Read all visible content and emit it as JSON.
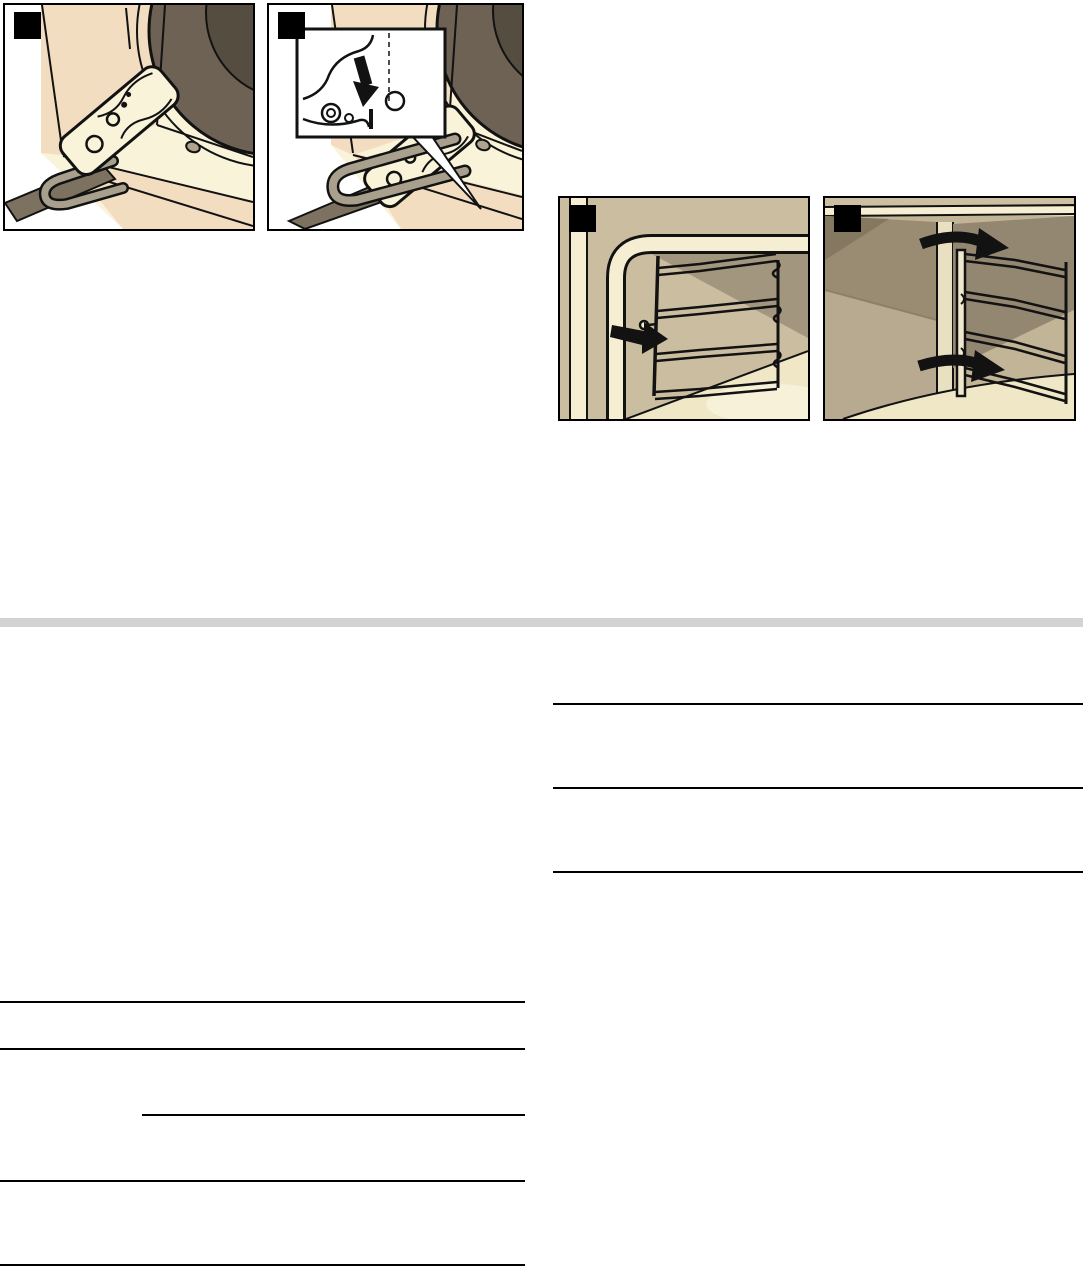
{
  "page": {
    "kind": "appliance manual page",
    "visible_text": ""
  },
  "colors": {
    "page_bg": "#ffffff",
    "panel_bg": "#f8f3d9",
    "panel_border": "#000000",
    "badge_black": "#000000",
    "divider_gray": "#d3d3d3",
    "rule_color": "#000000",
    "outline": "#121212",
    "white": "#ffffff",
    "tan_light": "#f3ddc1",
    "tan_mid": "#e6cfae",
    "wall_tan": "#cbbda0",
    "wall_shadow": "#a3967e",
    "wall_dark": "#857860",
    "glass_dark": "#6e6255",
    "glass_darker": "#554d3f",
    "metal_gray": "#a89f8d",
    "metal_dark": "#7d7260",
    "cream_strip": "#f5eed2",
    "floor_light": "#efe7c6",
    "floor_highlight": "#f7f1da"
  },
  "figures": [
    {
      "badge": "",
      "name": "oven-door-hinge-locking-lever"
    },
    {
      "badge": "",
      "name": "oven-door-hinge-lock-detail-inset"
    },
    {
      "badge": "",
      "name": "side-rack-unhook-pull"
    },
    {
      "badge": "",
      "name": "side-rack-swing-out"
    }
  ]
}
